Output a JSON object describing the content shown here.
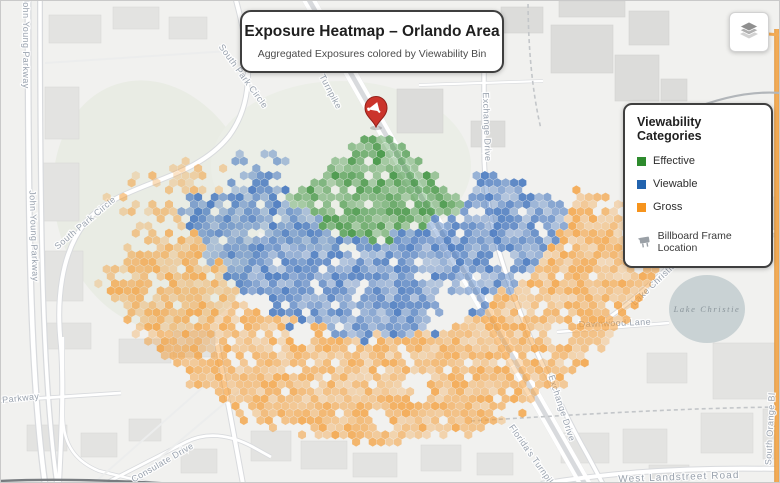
{
  "title_card": {
    "title": "Exposure Heatmap – Orlando Area",
    "subtitle": "Aggregated Exposures colored by Viewability Bin"
  },
  "legend": {
    "title": "Viewability Categories",
    "items": [
      {
        "label": "Effective",
        "color": "#2e8b2e"
      },
      {
        "label": "Viewable",
        "color": "#2263ae"
      },
      {
        "label": "Gross",
        "color": "#f6941d"
      }
    ],
    "marker_item": {
      "label": "Billboard Frame Location",
      "icon": "billboard-icon"
    }
  },
  "controls": {
    "layers_button": {
      "icon": "layers-icon"
    }
  },
  "map": {
    "lake_label": "Lake Christie",
    "marker": {
      "label": "billboard-frame-location",
      "color": "#cb342b"
    },
    "road_labels": [
      {
        "text": "John Young Parkway",
        "x": 22,
        "y": 42,
        "rotate": 90
      },
      {
        "text": "John Young Parkway",
        "x": 30,
        "y": 235,
        "rotate": 88
      },
      {
        "text": "South Park Circle",
        "x": 240,
        "y": 77,
        "rotate": 54
      },
      {
        "text": "South Park Circle",
        "x": 86,
        "y": 224,
        "rotate": -40
      },
      {
        "text": "Turnpike",
        "x": 327,
        "y": 92,
        "rotate": 62
      },
      {
        "text": "Exchange Drive",
        "x": 483,
        "y": 126,
        "rotate": 88
      },
      {
        "text": "Exchange Drive",
        "x": 558,
        "y": 408,
        "rotate": 72
      },
      {
        "text": "Florida's Turnpike",
        "x": 530,
        "y": 458,
        "rotate": 55
      },
      {
        "text": "West Landstreet Road",
        "x": 678,
        "y": 479,
        "rotate": -2,
        "size": "big"
      },
      {
        "text": "South Orange Bl",
        "x": 772,
        "y": 428,
        "rotate": -87
      },
      {
        "text": "Dawnwood Lane",
        "x": 614,
        "y": 325,
        "rotate": -2
      },
      {
        "text": "Lake Christie Drive",
        "x": 664,
        "y": 276,
        "rotate": -44
      },
      {
        "text": "Consulate Drive",
        "x": 163,
        "y": 464,
        "rotate": -30
      },
      {
        "text": "Parkway",
        "x": 20,
        "y": 400,
        "rotate": -6
      }
    ],
    "hexmap": {
      "center": {
        "x": 375,
        "y": 125
      },
      "hex_size": 4.8,
      "dropout": 0.07,
      "bands": [
        {
          "name": "Effective",
          "color": "#3f9340",
          "r": [
            10,
            113
          ],
          "theta": [
            40,
            140
          ],
          "op": [
            0.35,
            0.9
          ]
        },
        {
          "name": "Viewable",
          "color": "#4073bd",
          "r": [
            113,
            212
          ],
          "theta": [
            22,
            158
          ],
          "op": [
            0.33,
            0.88
          ]
        },
        {
          "name": "Gross",
          "color": "#f49b33",
          "r": [
            212,
            316
          ],
          "theta": [
            17,
            152
          ],
          "op": [
            0.28,
            0.78
          ]
        }
      ],
      "strays": [
        {
          "color": "#f49b33",
          "r": [
            150,
            278
          ],
          "theta": [
            138,
            171
          ],
          "density": 0.32,
          "op": [
            0.25,
            0.6
          ]
        },
        {
          "color": "#4073bd",
          "r": [
            100,
            152
          ],
          "theta": [
            152,
            167
          ],
          "density": 0.25,
          "op": [
            0.3,
            0.6
          ]
        }
      ],
      "holes": [
        [
          445,
          312,
          20
        ],
        [
          418,
          386,
          15
        ],
        [
          300,
          332,
          12
        ],
        [
          352,
          252,
          9
        ],
        [
          500,
          262,
          10
        ],
        [
          558,
          332,
          12
        ],
        [
          428,
          162,
          9
        ],
        [
          470,
          300,
          10
        ],
        [
          380,
          420,
          10
        ],
        [
          255,
          300,
          10
        ]
      ]
    }
  }
}
